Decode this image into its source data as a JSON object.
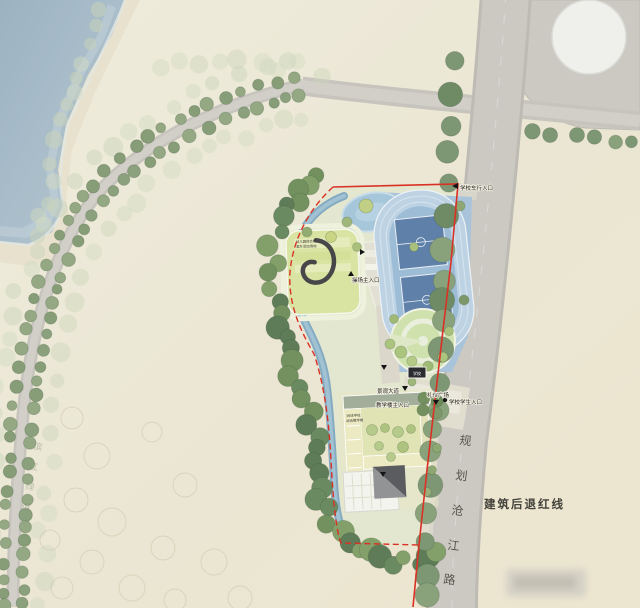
{
  "plan": {
    "labels": {
      "vehicle_entrance": "学校车行入口",
      "track_entrance": "操场主入口",
      "landscape_avenue": "景观大道",
      "teaching_entrance": "教学楼主入口",
      "ceremony_plaza": "礼仪广场",
      "student_entrance": "学校学生入口",
      "setback_line": "建筑后退红线",
      "gate_sign": "学校"
    },
    "roads": {
      "right_name": "规划沧江路",
      "left_name": "滨江绿道"
    },
    "buildings": {
      "kindergarten_line1": "幼儿园综合楼",
      "kindergarten_line2": "室外活动场地",
      "school_line1": "36班学校",
      "school_line2": "综合教学楼"
    },
    "colors": {
      "red_line": "#da3125",
      "river_water": "#a7bcca",
      "track_pad": "#a9c4da",
      "infield": "#9dbcd6",
      "court": "#5f81a9",
      "lawn_circle": "#cfe2ad",
      "paper": "#ece7d6",
      "tree_dark": "#5e7c57",
      "tree_light": "#b6cb8b",
      "canal": "#85abc2"
    }
  }
}
